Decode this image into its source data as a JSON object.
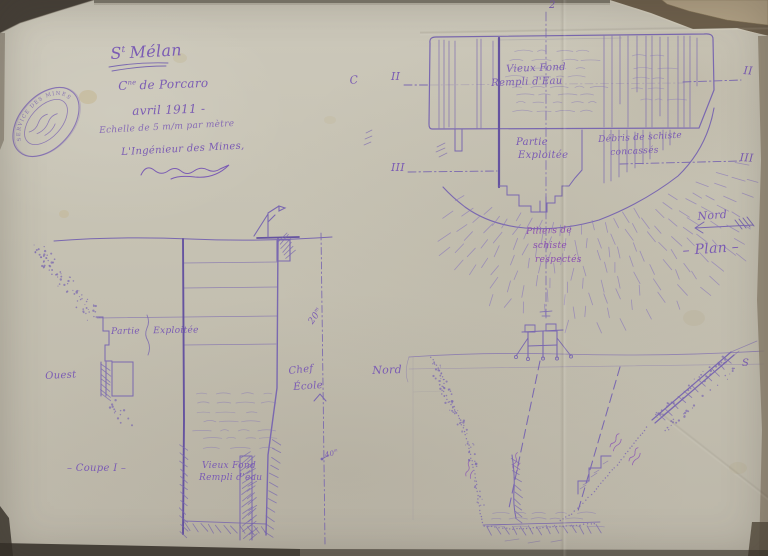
{
  "stamp": {
    "legend": "SERVICE DES MINES"
  },
  "title_block": {
    "title_s": "S",
    "title_sup": "t",
    "title_rest": "Mélan",
    "commune_c": "C",
    "commune_sup": "ne",
    "commune_rest": "de Porcaro",
    "date": "avril 1911 -",
    "scale": "Echelle de 5 m/m par mètre",
    "engineer": "L'Ingénieur des Mines,"
  },
  "plan": {
    "axis_label": "2",
    "left_letter": "C",
    "section_II_left": "II",
    "section_II_right": "II",
    "section_III_left": "III",
    "section_III_right": "III",
    "vieux_fond_1": "Vieux Fond",
    "vieux_fond_2": "Rempli d'Eau",
    "partie_1": "Partie",
    "partie_2": "Exploitée",
    "debris_1": "Débris de schiste",
    "debris_2": "concassés",
    "piliers_1": "Piliers de",
    "piliers_2": "schiste",
    "piliers_3": "respectés",
    "north_label": "Nord",
    "caption": "– Plan –"
  },
  "coupe_I": {
    "west_label": "Ouest",
    "partie_exploitee": "Partie Exploitée",
    "caption": "– Coupe I –",
    "vieux_fond_1": "Vieux Fond",
    "vieux_fond_2": "Rempli d'eau"
  },
  "scale_line": {
    "mark_20": "20",
    "mark_40": "40",
    "unit_m": "m",
    "note_1": "Chef",
    "note_2": "École"
  },
  "coupe_II": {
    "north_label": "Nord",
    "south_label": "S"
  }
}
